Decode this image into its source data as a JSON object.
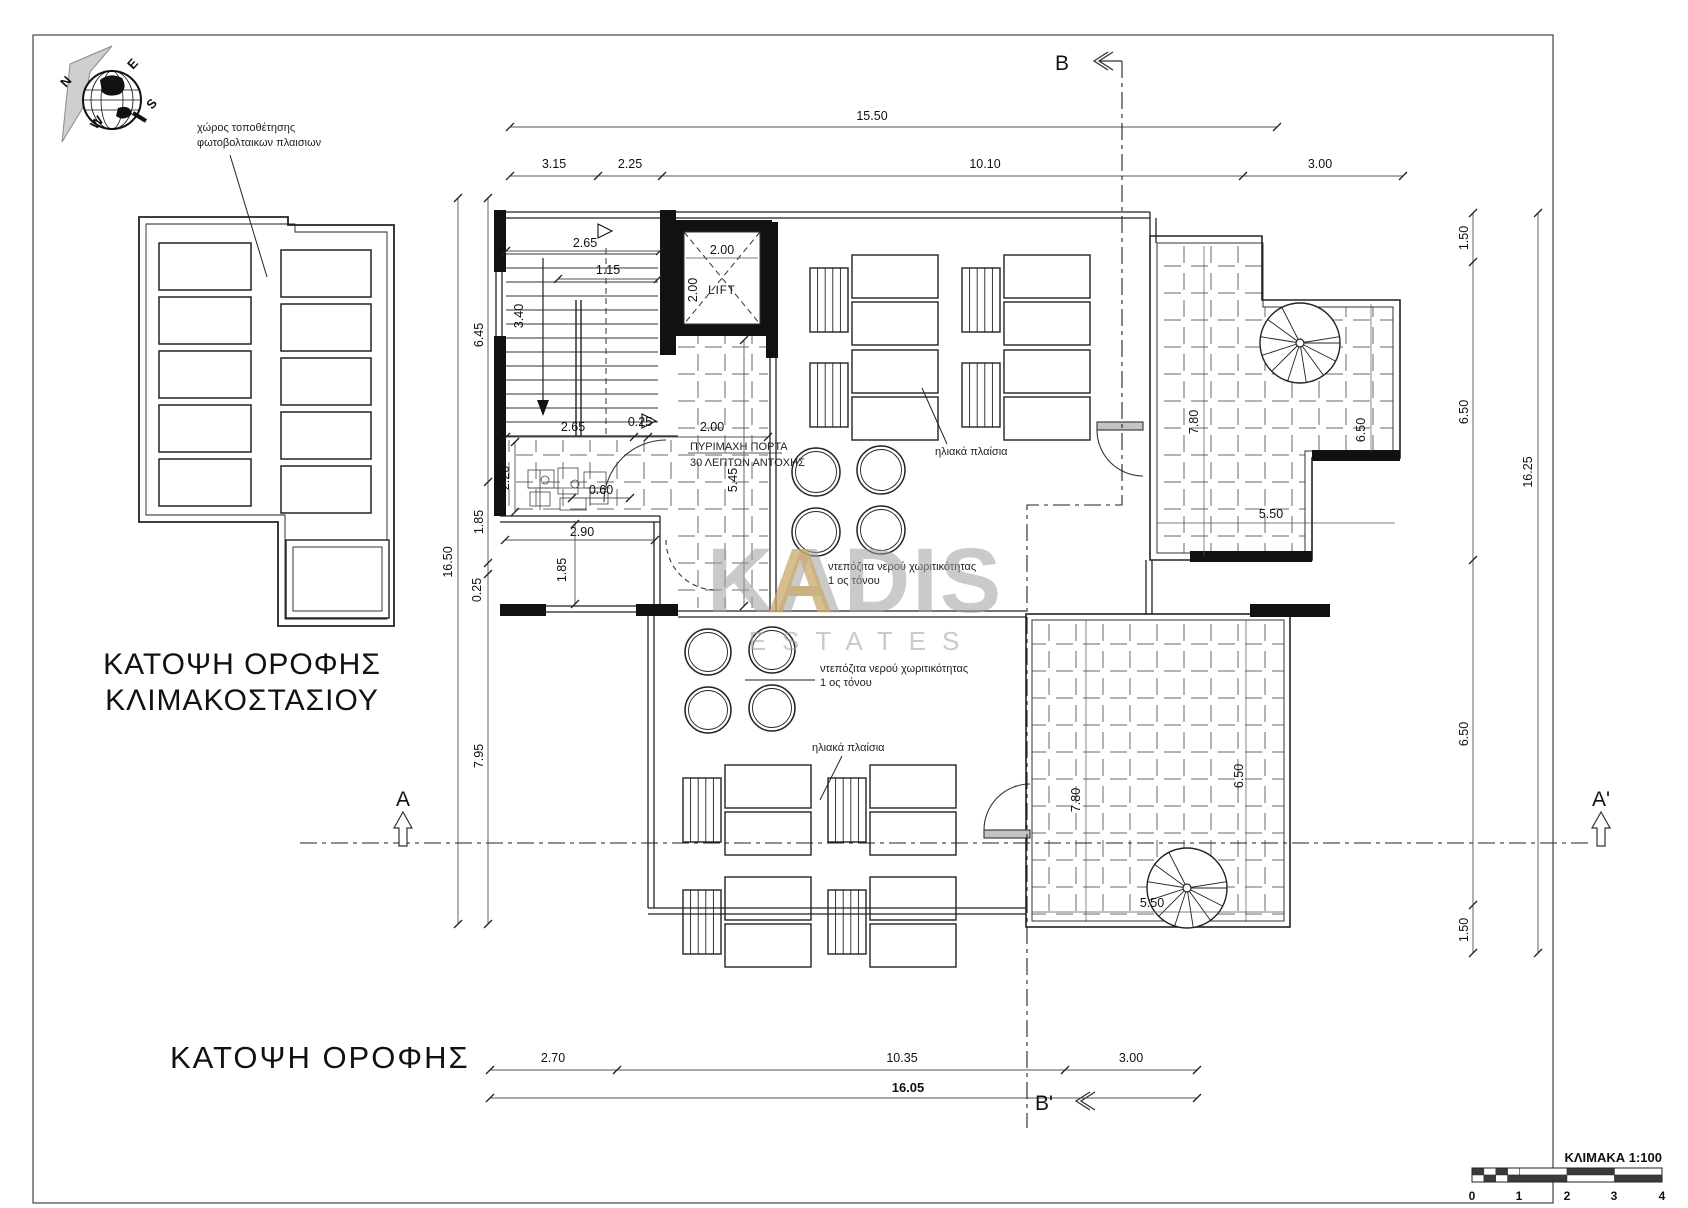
{
  "titles": {
    "left_plan_line1": "ΚΑΤΟΨΗ  ΟΡΟΦΗΣ",
    "left_plan_line2": "ΚΛΙΜΑΚΟΣΤΑΣΙΟΥ",
    "main_plan": "ΚΑΤΟΨΗ  ΟΡΟΦΗΣ"
  },
  "compass": {
    "n": "N",
    "e": "E",
    "s": "S",
    "w": "W"
  },
  "section_markers": {
    "a": "A",
    "a_prime": "A'",
    "b": "B",
    "b_prime": "B'"
  },
  "notes": {
    "pv_area_line1": "χώρος τοποθέτησης",
    "pv_area_line2": "φωτοβολταικων πλαισιων",
    "solar_panels_top": "ηλιακά πλαίσια",
    "solar_panels_bottom": "ηλιακά πλαίσια",
    "tanks_top_line1": "ντεπόζιτα νερού χωριτικότητας",
    "tanks_top_line2": "1 ος τόνου",
    "tanks_bottom_line1": "ντεπόζιτα νερού χωριτικότητας",
    "tanks_bottom_line2": "1 ος τόνου",
    "fire_door_line1": "ΠΥΡΙΜΑΧΗ ΠΟΡΤΑ",
    "fire_door_line2": "30 ΛΕΠΤΩΝ ΑΝΤΟΧΗΣ",
    "lift": "LIFT"
  },
  "dims": {
    "top_overall": "15.50",
    "top_1": "3.15",
    "top_2": "2.25",
    "top_3": "10.10",
    "top_4": "3.00",
    "left_overall": "16.50",
    "left_1": "6.45",
    "left_2": "1.85",
    "left_3": "0.25",
    "left_4": "7.95",
    "right_overall": "16.25",
    "right_1": "1.50",
    "right_2": "6.50",
    "right_3": "6.50",
    "right_4": "1.50",
    "bottom_overall": "16.05",
    "bottom_1": "2.70",
    "bottom_2": "10.35",
    "bottom_3": "3.00",
    "stair_w": "2.65",
    "stair_1": "1.15",
    "stair_2": "3.40",
    "lift_w": "2.00",
    "lift_h": "2.00",
    "mid_1": "2.65",
    "mid_2": "0.25",
    "mid_3": "2.00",
    "corridor_h": "5.45",
    "small_1": "2.20",
    "small_2": "0.60",
    "room_w": "2.90",
    "room_h": "1.85",
    "terr_top_h": "7.80",
    "terr_top_w": "6.50",
    "terr_top_b": "5.50",
    "terr_bot_h": "7.80",
    "terr_bot_w": "6.50",
    "terr_bot_b": "5.50"
  },
  "watermark": {
    "name": "KADIS",
    "accent_letter": "A",
    "subtitle": "ESTATES"
  },
  "scalebar": {
    "label": "ΚΛΙΜΑΚΑ  1:100",
    "n0": "0",
    "n1": "1",
    "n2": "2",
    "n3": "3",
    "n4": "4"
  },
  "colors": {
    "wall": "#111111",
    "dim_line": "#555555",
    "hatch": "#666666",
    "watermark_gray": "#9f9f9f",
    "watermark_gold": "#c9a96a",
    "scale_dark": "#3a3a3a"
  }
}
